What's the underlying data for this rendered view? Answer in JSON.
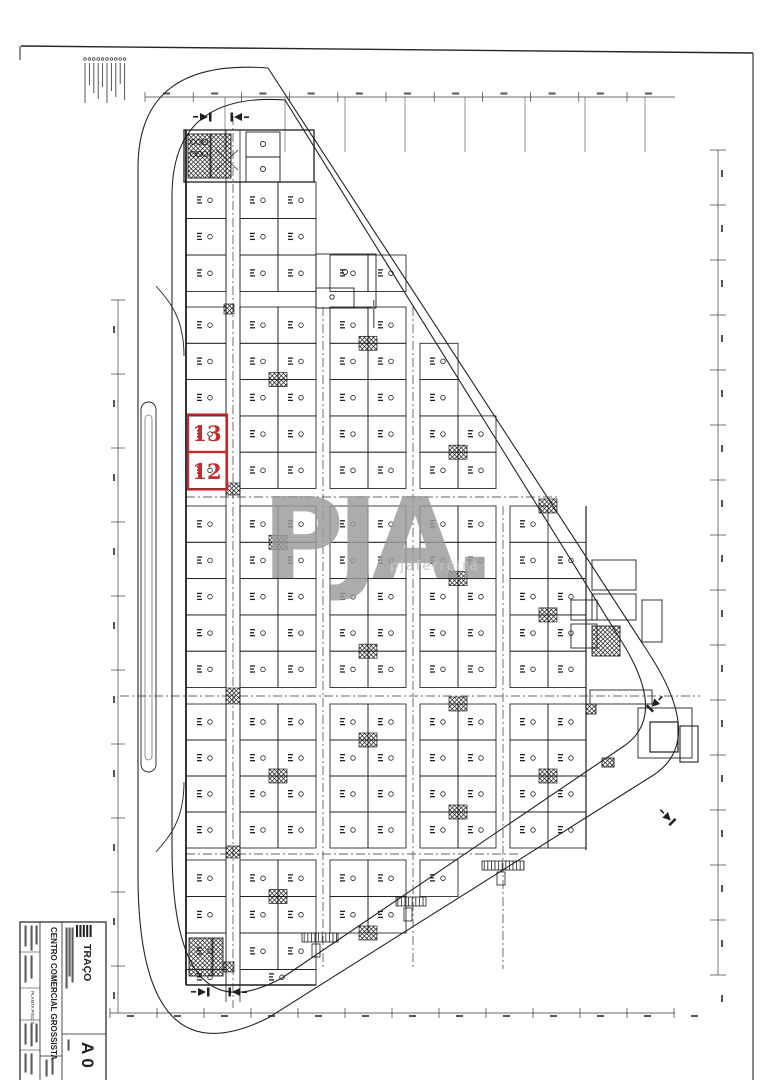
{
  "watermark": {
    "text": "PJA.",
    "subtext": "pjaferreira"
  },
  "highlighted_units": {
    "color": "#c62a2a",
    "units": [
      {
        "label": "13"
      },
      {
        "label": "12"
      }
    ]
  },
  "title_block": {
    "firm_name": "TRAÇO",
    "project_title": "CENTRO COMERCIAL GROSSISTA",
    "drawing_title": "PLANTA PISO 0",
    "sheet_number": "A 0"
  },
  "legend": {
    "item_count": 10
  },
  "colors": {
    "ink": "#1f1f1f",
    "dim_line": "#3a3a3a",
    "watermark_gray": "#9b9b9b",
    "highlight_red": "#c62a2a",
    "micro_text": "#555555"
  }
}
